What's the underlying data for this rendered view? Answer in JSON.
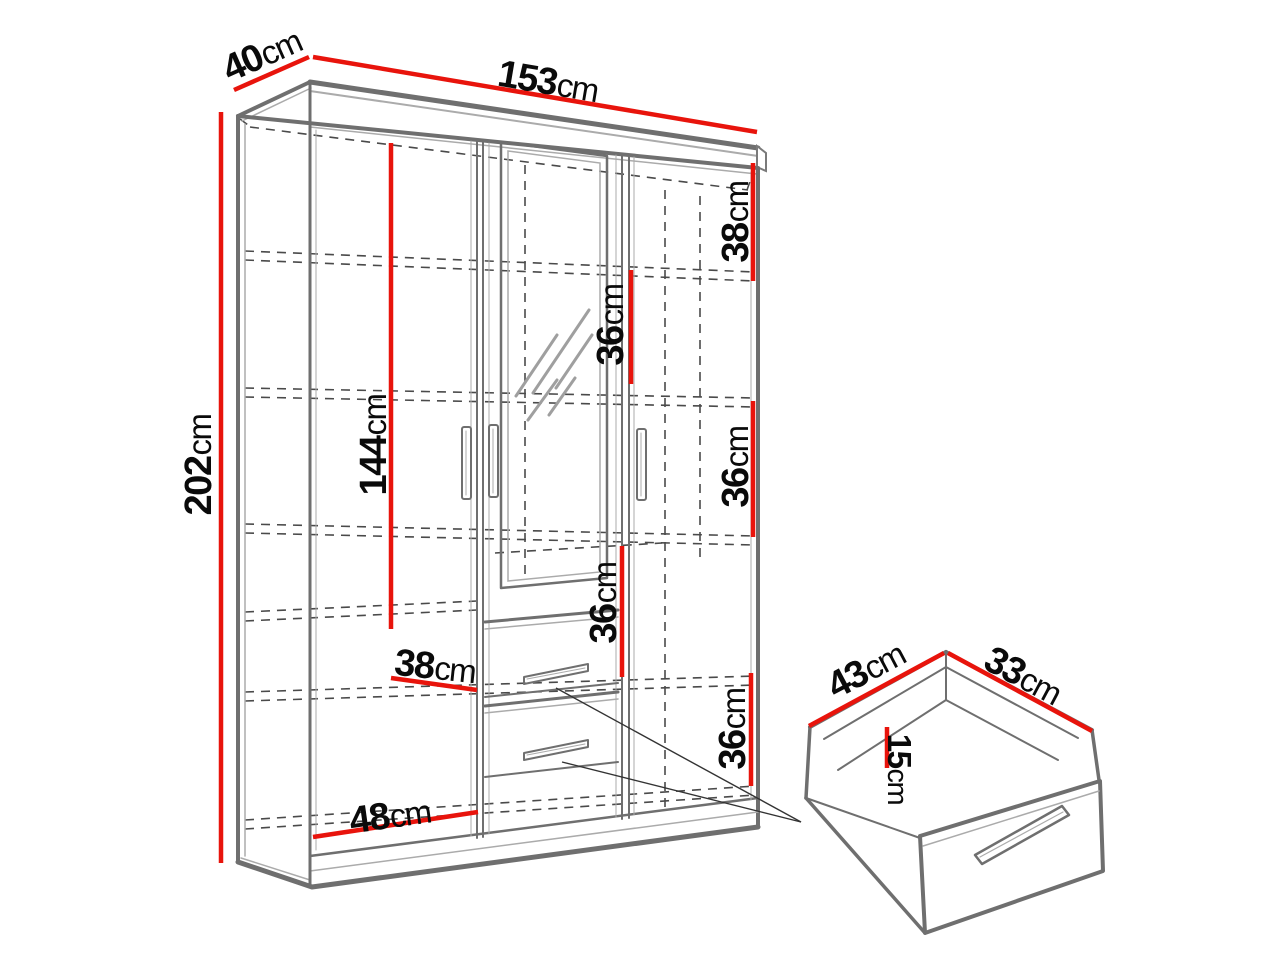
{
  "figure": {
    "kind": "wardrobe dimension diagram",
    "unit": "cm"
  },
  "colors": {
    "dimension_line": "#e8140c",
    "outline": "#6f6f6f",
    "outline_light": "#ababab",
    "dashed": "#4a4a4a",
    "text": "#0a0a0a",
    "background": "#ffffff"
  },
  "labels": {
    "depth_top": {
      "value": "40",
      "unit": "cm"
    },
    "width_top": {
      "value": "153",
      "unit": "cm"
    },
    "height_left": {
      "value": "202",
      "unit": "cm"
    },
    "interior_height": {
      "value": "144",
      "unit": "cm"
    },
    "section_right_top": {
      "value": "38",
      "unit": "cm"
    },
    "section_mid_upper": {
      "value": "36",
      "unit": "cm"
    },
    "section_right_mid": {
      "value": "36",
      "unit": "cm"
    },
    "section_mid_lower": {
      "value": "36",
      "unit": "cm"
    },
    "section_right_bottom": {
      "value": "36",
      "unit": "cm"
    },
    "shelf_left": {
      "value": "38",
      "unit": "cm"
    },
    "bottom_width": {
      "value": "48",
      "unit": "cm"
    },
    "drawer_depth": {
      "value": "43",
      "unit": "cm"
    },
    "drawer_width": {
      "value": "33",
      "unit": "cm"
    },
    "drawer_height": {
      "value": "15",
      "unit": "cm"
    }
  }
}
